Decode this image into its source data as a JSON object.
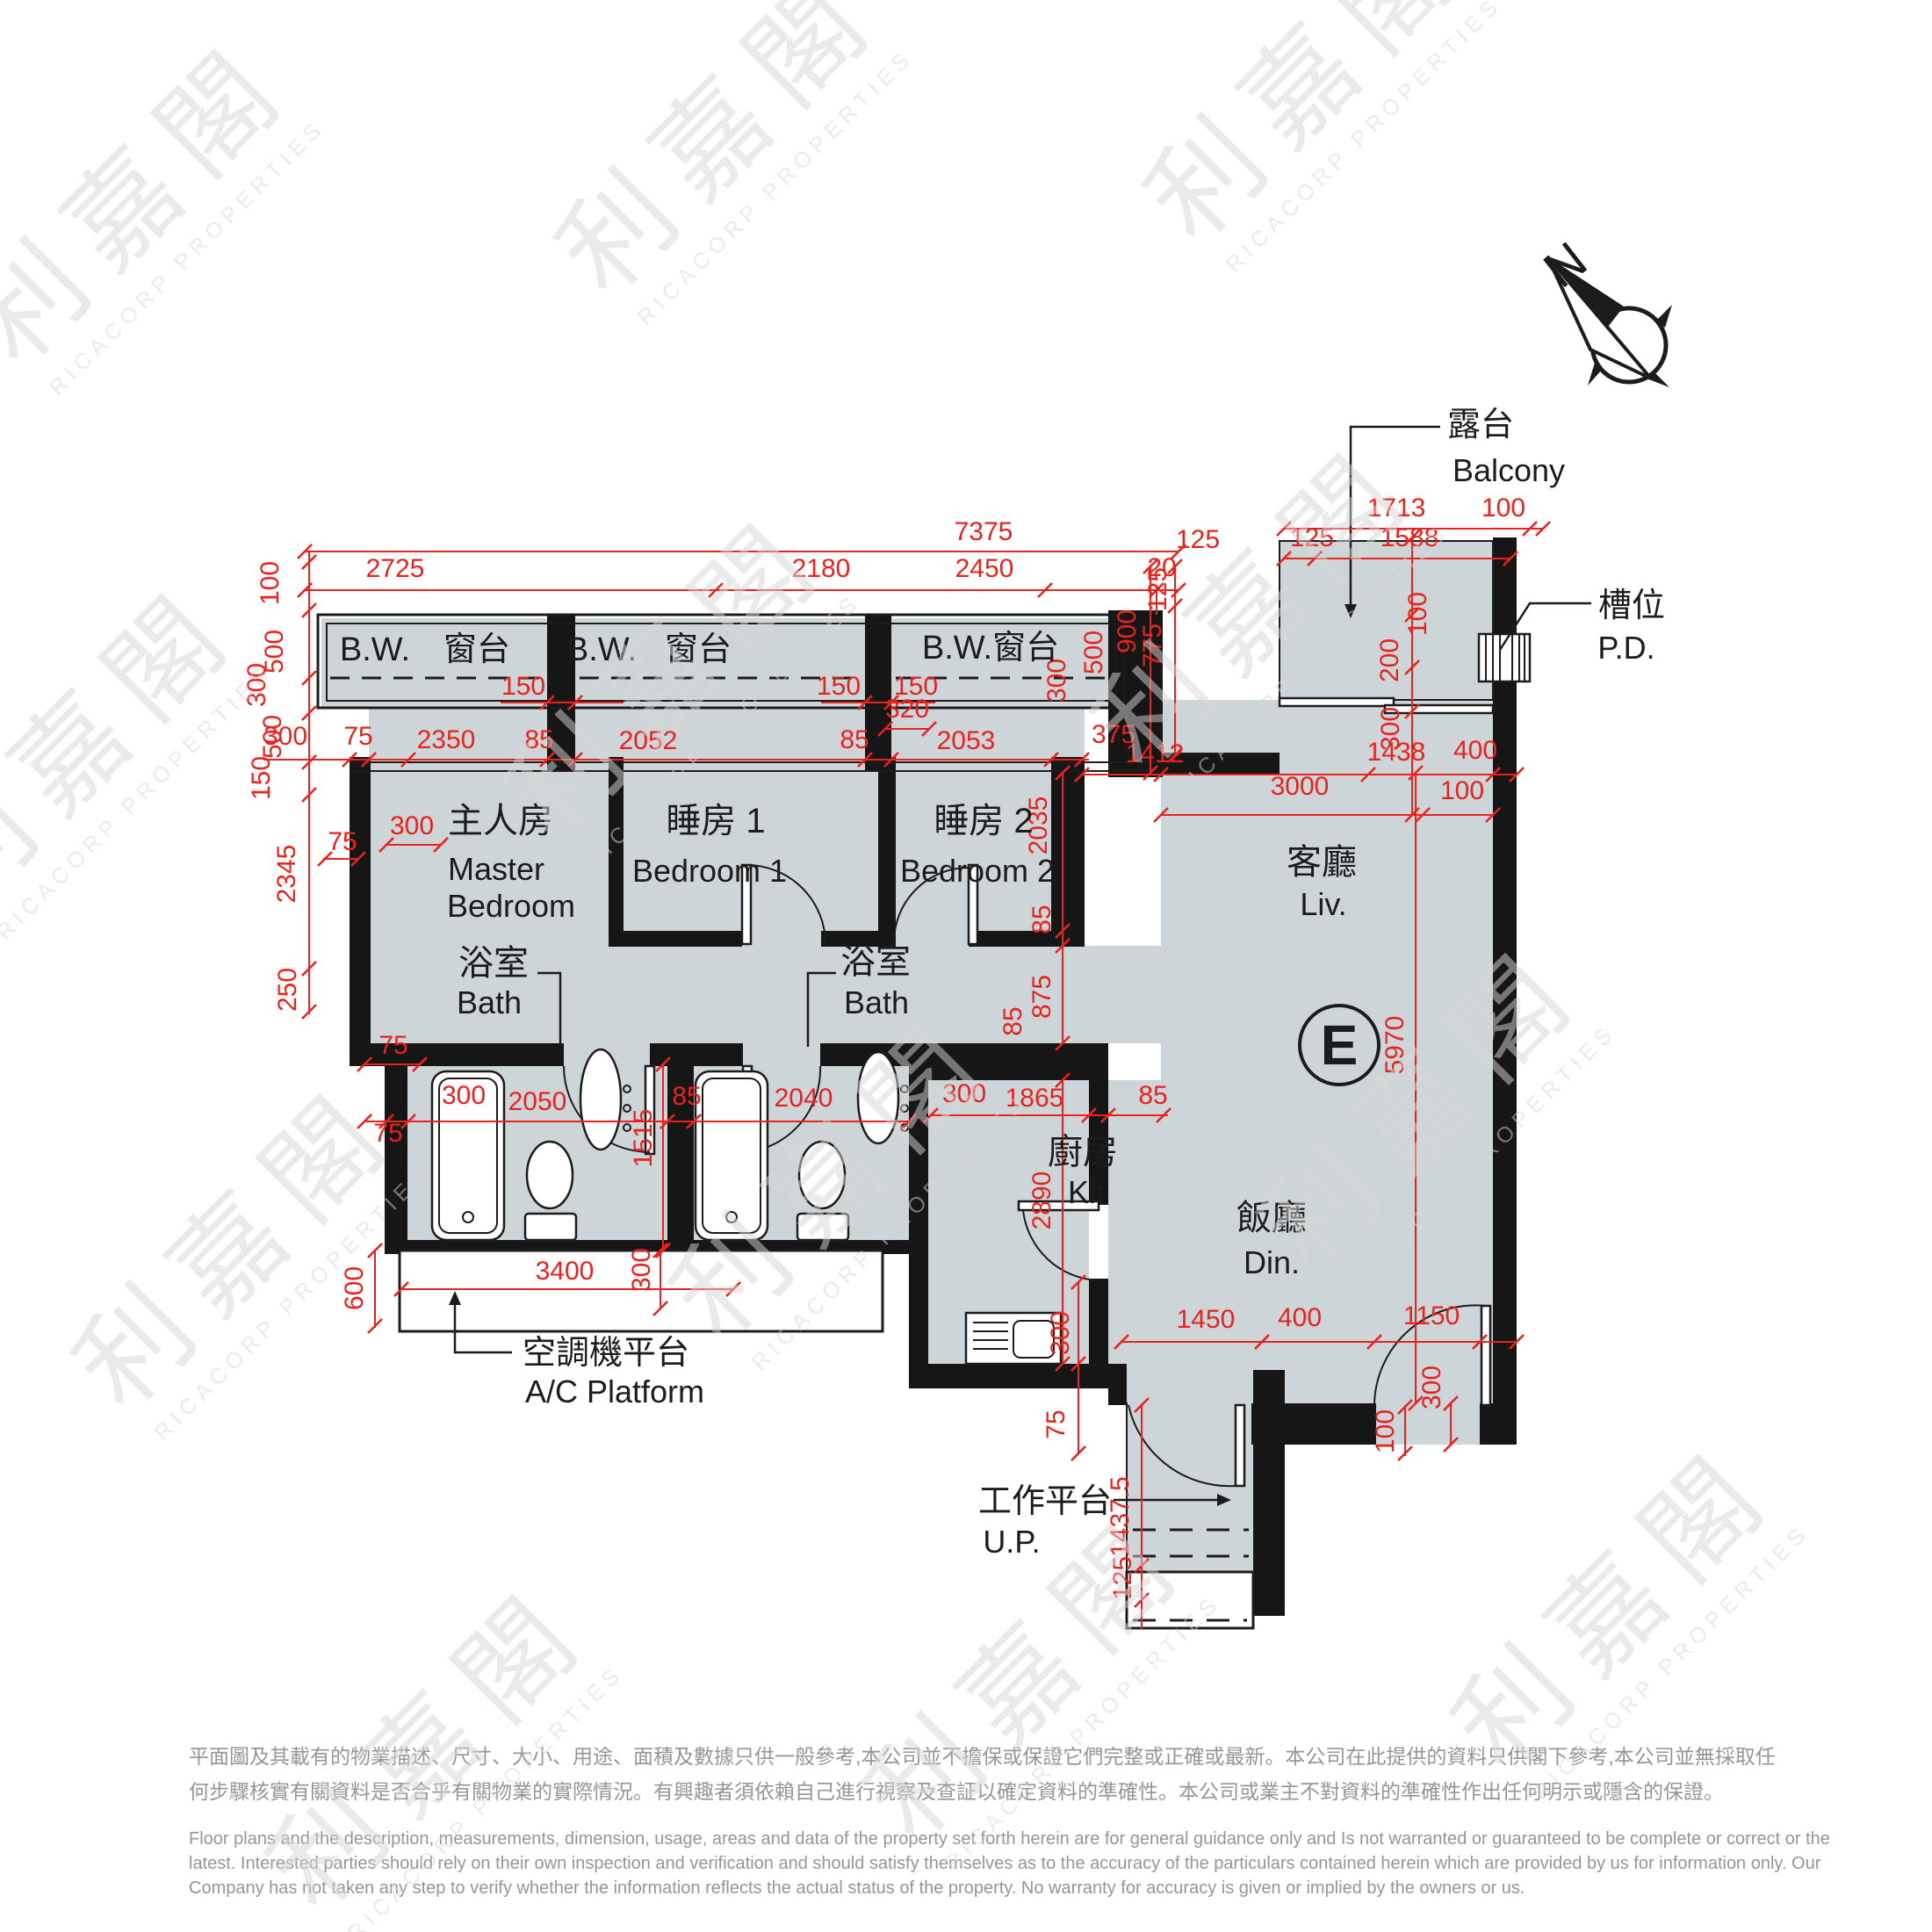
{
  "compass": {
    "label": "N"
  },
  "unit": {
    "label": "E"
  },
  "callouts": {
    "balcony": {
      "zh": "露台",
      "en": "Balcony"
    },
    "pd": {
      "zh": "槽位",
      "en": "P.D."
    },
    "ac": {
      "zh": "空調機平台",
      "en": "A/C Platform"
    },
    "up": {
      "zh": "工作平台",
      "en": "U.P."
    }
  },
  "plan_labels": [
    [
      "master-bedroom-zh",
      "主人房",
      570,
      948,
      40
    ],
    [
      "master-bedroom-en1",
      "Master",
      565,
      1002,
      36
    ],
    [
      "master-bedroom-en2",
      "Bedroom",
      582,
      1044,
      36
    ],
    [
      "bedroom1-zh",
      "睡房 1",
      815,
      948,
      40
    ],
    [
      "bedroom1-en",
      "Bedroom 1",
      808,
      1004,
      36
    ],
    [
      "bedroom2-zh",
      "睡房 2",
      1120,
      948,
      40
    ],
    [
      "bedroom2-en",
      "Bedroom 2",
      1113,
      1004,
      36
    ],
    [
      "bath1-zh",
      "浴室",
      562,
      1110,
      40
    ],
    [
      "bath1-en",
      "Bath",
      557,
      1154,
      36
    ],
    [
      "bath2-zh",
      "浴室",
      997,
      1108,
      40
    ],
    [
      "bath2-en",
      "Bath",
      998,
      1154,
      36
    ],
    [
      "kitchen-zh",
      "廚房",
      1233,
      1325,
      40
    ],
    [
      "kitchen-en",
      "Kit",
      1237,
      1370,
      36
    ],
    [
      "living-zh",
      "客廳",
      1505,
      995,
      40
    ],
    [
      "living-en",
      "Liv.",
      1507,
      1042,
      36
    ],
    [
      "dining-zh",
      "飯廳",
      1448,
      1400,
      40
    ],
    [
      "dining-en",
      "Din.",
      1448,
      1450,
      36
    ],
    [
      "bay-window-1-bw",
      "B.W.",
      427,
      752,
      38
    ],
    [
      "bay-window-1-win",
      "窗台",
      543,
      752,
      38
    ],
    [
      "bay-window-2-bw",
      "B.W.",
      685,
      752,
      38
    ],
    [
      "bay-window-2-win",
      "窗台",
      795,
      752,
      38
    ],
    [
      "bay-window-3",
      "B.W.窗台",
      1128,
      750,
      38
    ]
  ],
  "dims": [
    [
      "7375",
      1120,
      615,
      0
    ],
    [
      "2725",
      450,
      657,
      0
    ],
    [
      "2180",
      935,
      657,
      0
    ],
    [
      "20",
      1323,
      656,
      0
    ],
    [
      "2450",
      1121,
      657,
      0
    ],
    [
      "100",
      317,
      664,
      1
    ],
    [
      "500",
      322,
      742,
      1
    ],
    [
      "300",
      302,
      780,
      1
    ],
    [
      "500",
      320,
      839,
      1
    ],
    [
      "150",
      307,
      886,
      1
    ],
    [
      "2345",
      336,
      995,
      1
    ],
    [
      "250",
      337,
      1127,
      1
    ],
    [
      "600",
      413,
      1467,
      1
    ],
    [
      "150",
      596,
      791,
      0
    ],
    [
      "150",
      955,
      791,
      0
    ],
    [
      "150",
      1043,
      791,
      0
    ],
    [
      "320",
      1033,
      817,
      0
    ],
    [
      "300",
      325,
      848,
      0
    ],
    [
      "75",
      408,
      848,
      0
    ],
    [
      "2350",
      508,
      852,
      0
    ],
    [
      "85",
      614,
      852,
      0
    ],
    [
      "2052",
      738,
      853,
      0
    ],
    [
      "85",
      973,
      852,
      0
    ],
    [
      "2053",
      1100,
      853,
      0
    ],
    [
      "300",
      469,
      950,
      0
    ],
    [
      "75",
      390,
      968,
      0
    ],
    [
      "75",
      448,
      1200,
      0
    ],
    [
      "500",
      1255,
      743,
      1
    ],
    [
      "300",
      1213,
      775,
      1
    ],
    [
      "375",
      1268,
      846,
      0
    ],
    [
      "1412",
      1315,
      868,
      0
    ],
    [
      "1438",
      1590,
      866,
      0
    ],
    [
      "400",
      1680,
      864,
      0
    ],
    [
      "3000",
      1480,
      905,
      0
    ],
    [
      "100",
      1665,
      910,
      0
    ],
    [
      "1713",
      1590,
      588,
      0
    ],
    [
      "100",
      1712,
      588,
      0
    ],
    [
      "125",
      1364,
      624,
      0
    ],
    [
      "125",
      1494,
      622,
      0
    ],
    [
      "1588",
      1605,
      622,
      0
    ],
    [
      "900",
      1293,
      719,
      1
    ],
    [
      "775",
      1322,
      735,
      1
    ],
    [
      "125",
      1328,
      671,
      1
    ],
    [
      "100",
      1624,
      699,
      1
    ],
    [
      "200",
      1592,
      752,
      1
    ],
    [
      "300",
      1593,
      830,
      1
    ],
    [
      "2035",
      1192,
      940,
      1
    ],
    [
      "85",
      1196,
      1047,
      1
    ],
    [
      "875",
      1196,
      1135,
      1
    ],
    [
      "85",
      1163,
      1163,
      1
    ],
    [
      "5970",
      1598,
      1190,
      1
    ],
    [
      "300",
      528,
      1257,
      0
    ],
    [
      "2050",
      612,
      1264,
      0
    ],
    [
      "85",
      782,
      1258,
      0
    ],
    [
      "2040",
      915,
      1260,
      0
    ],
    [
      "1515",
      742,
      1296,
      1
    ],
    [
      "75",
      442,
      1300,
      0
    ],
    [
      "300",
      1098,
      1255,
      0
    ],
    [
      "1865",
      1178,
      1260,
      0
    ],
    [
      "85",
      1313,
      1257,
      0
    ],
    [
      "2890",
      1196,
      1367,
      1
    ],
    [
      "3400",
      643,
      1457,
      0
    ],
    [
      "300",
      740,
      1446,
      1
    ],
    [
      "300",
      1217,
      1518,
      1
    ],
    [
      "75",
      1212,
      1622,
      1
    ],
    [
      "1450",
      1373,
      1512,
      0
    ],
    [
      "400",
      1480,
      1510,
      0
    ],
    [
      "1150",
      1630,
      1508,
      0
    ],
    [
      "300",
      1640,
      1580,
      1
    ],
    [
      "100",
      1587,
      1630,
      1
    ],
    [
      "1437.5",
      1285,
      1727,
      1
    ],
    [
      "125",
      1288,
      1797,
      1
    ]
  ],
  "dim_lines": [
    [
      347,
      628,
      1342,
      628
    ],
    [
      347,
      672,
      1342,
      672
    ],
    [
      352,
      628,
      352,
      1155
    ],
    [
      427,
      1423,
      427,
      1512
    ],
    [
      457,
      1468,
      835,
      1468
    ],
    [
      300,
      865,
      1240,
      865
    ],
    [
      415,
      1277,
      1035,
      1277
    ],
    [
      1060,
      1270,
      1330,
      1270
    ],
    [
      755,
      1212,
      755,
      1424
    ],
    [
      1232,
      882,
      1727,
      882
    ],
    [
      1322,
      928,
      1700,
      928
    ],
    [
      1612,
      880,
      1612,
      1598
    ],
    [
      1210,
      880,
      1210,
      1188
    ],
    [
      1210,
      1230,
      1210,
      1553
    ],
    [
      1462,
      602,
      1757,
      602
    ],
    [
      1462,
      636,
      1720,
      636
    ],
    [
      1310,
      645,
      1310,
      880
    ],
    [
      1338,
      645,
      1338,
      860
    ],
    [
      1608,
      612,
      1608,
      928
    ],
    [
      1317,
      668,
      1317,
      700
    ],
    [
      1277,
      1528,
      1727,
      1528
    ],
    [
      1652,
      1598,
      1652,
      1645
    ],
    [
      1600,
      1600,
      1600,
      1658
    ],
    [
      1300,
      1600,
      1300,
      1855
    ],
    [
      1228,
      1460,
      1228,
      1655
    ],
    [
      752,
      1424,
      752,
      1490
    ],
    [
      570,
      800,
      710,
      800
    ],
    [
      935,
      800,
      1065,
      800
    ],
    [
      1008,
      830,
      1058,
      830
    ],
    [
      440,
      962,
      502,
      962
    ],
    [
      368,
      978,
      408,
      978
    ],
    [
      415,
      1212,
      478,
      1212
    ]
  ],
  "ticks": [
    [
      347,
      628
    ],
    [
      1342,
      628
    ],
    [
      347,
      672
    ],
    [
      815,
      672
    ],
    [
      1190,
      672
    ],
    [
      1317,
      672
    ],
    [
      1342,
      672
    ],
    [
      352,
      640
    ],
    [
      352,
      695
    ],
    [
      352,
      772
    ],
    [
      352,
      812
    ],
    [
      352,
      868
    ],
    [
      352,
      905
    ],
    [
      352,
      1103
    ],
    [
      352,
      1152
    ],
    [
      427,
      1424
    ],
    [
      427,
      1510
    ],
    [
      457,
      1468
    ],
    [
      835,
      1468
    ],
    [
      398,
      865
    ],
    [
      420,
      865
    ],
    [
      465,
      865
    ],
    [
      623,
      865
    ],
    [
      655,
      865
    ],
    [
      985,
      865
    ],
    [
      1015,
      865
    ],
    [
      1197,
      865
    ],
    [
      1232,
      865
    ],
    [
      415,
      1277
    ],
    [
      440,
      1277
    ],
    [
      465,
      1277
    ],
    [
      760,
      1277
    ],
    [
      790,
      1277
    ],
    [
      1035,
      1277
    ],
    [
      1060,
      1270
    ],
    [
      1240,
      1270
    ],
    [
      1262,
      1270
    ],
    [
      1325,
      1270
    ],
    [
      755,
      1212
    ],
    [
      755,
      1424
    ],
    [
      1232,
      882
    ],
    [
      1322,
      882
    ],
    [
      1558,
      882
    ],
    [
      1700,
      882
    ],
    [
      1727,
      882
    ],
    [
      1322,
      928
    ],
    [
      1620,
      928
    ],
    [
      1700,
      928
    ],
    [
      1612,
      880
    ],
    [
      1612,
      1598
    ],
    [
      1210,
      880
    ],
    [
      1210,
      1060
    ],
    [
      1210,
      1077
    ],
    [
      1210,
      1188
    ],
    [
      1210,
      1230
    ],
    [
      1210,
      1553
    ],
    [
      1462,
      602
    ],
    [
      1742,
      602
    ],
    [
      1757,
      602
    ],
    [
      1462,
      636
    ],
    [
      1497,
      636
    ],
    [
      1720,
      636
    ],
    [
      1310,
      645
    ],
    [
      1310,
      880
    ],
    [
      1338,
      645
    ],
    [
      1338,
      690
    ],
    [
      1338,
      860
    ],
    [
      1608,
      612
    ],
    [
      1608,
      700
    ],
    [
      1608,
      760
    ],
    [
      1608,
      810
    ],
    [
      1608,
      928
    ],
    [
      1277,
      1528
    ],
    [
      1437,
      1528
    ],
    [
      1565,
      1528
    ],
    [
      1685,
      1528
    ],
    [
      1727,
      1528
    ],
    [
      1652,
      1598
    ],
    [
      1652,
      1645
    ],
    [
      1600,
      1602
    ],
    [
      1600,
      1655
    ],
    [
      1300,
      1600
    ],
    [
      1300,
      1783
    ],
    [
      1300,
      1822
    ],
    [
      1228,
      1460
    ],
    [
      1228,
      1553
    ],
    [
      1228,
      1655
    ],
    [
      752,
      1424
    ],
    [
      752,
      1490
    ],
    [
      623,
      800
    ],
    [
      655,
      800
    ],
    [
      985,
      800
    ],
    [
      1015,
      800
    ],
    [
      1008,
      830
    ],
    [
      1058,
      830
    ],
    [
      440,
      962
    ],
    [
      502,
      962
    ],
    [
      370,
      978
    ],
    [
      408,
      978
    ],
    [
      415,
      1212
    ],
    [
      478,
      1212
    ]
  ],
  "watermark": {
    "zh": "利嘉閣",
    "en": "RICACORP PROPERTIES",
    "positions": [
      [
        180,
        260
      ],
      [
        850,
        180
      ],
      [
        1520,
        120
      ],
      [
        120,
        880
      ],
      [
        790,
        800
      ],
      [
        1460,
        720
      ],
      [
        300,
        1450
      ],
      [
        980,
        1370
      ],
      [
        1650,
        1290
      ],
      [
        520,
        2020
      ],
      [
        1200,
        1940
      ],
      [
        1870,
        1860
      ]
    ]
  },
  "disclaimer": {
    "zh": [
      "平面圖及其載有的物業描述、尺寸、大小、用途、面積及數據只供一般參考,本公司並不擔保或保證它們完整或正確或最新。本公司在此提供的資料只供閣下參考,本公司並無採取任",
      "何步驟核實有關資料是否合乎有關物業的實際情況。有興趣者須依賴自己進行視察及查証以確定資料的準確性。本公司或業主不對資料的準確性作出任何明示或隱含的保證。"
    ],
    "en": [
      "Floor plans and the description, measurements, dimension, usage, areas and data of the property set forth herein are for general guidance only and Is not warranted or guaranteed to be complete or correct or the",
      "latest. Interested parties should rely on their own inspection and verification and should satisfy themselves as to the accuracy of the particulars contained herein which are provided by us for information only.  Our",
      "Company has not taken any step to verify whether the information reflects the actual status of the property.  No warranty for accuracy is given or implied by the owners or us."
    ]
  }
}
